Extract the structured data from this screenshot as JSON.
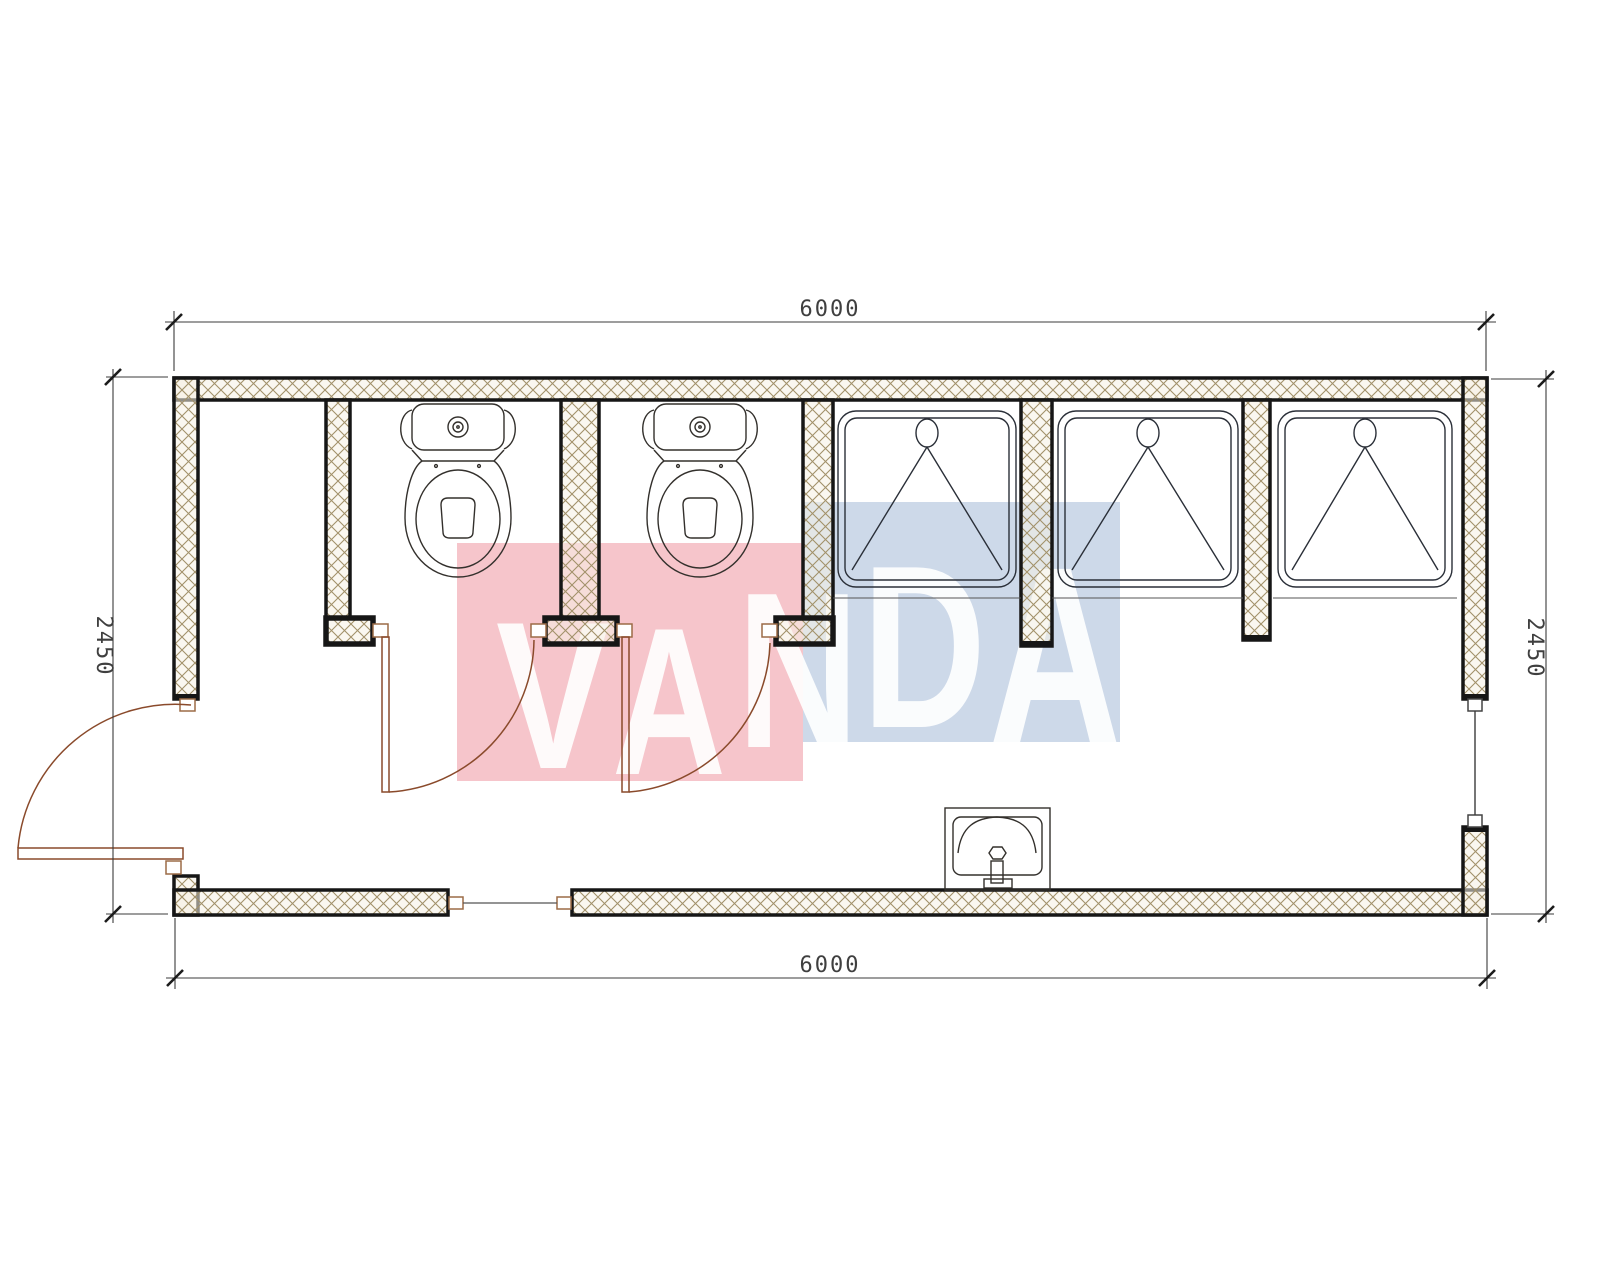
{
  "title": "Sanitary container floor plan 6000 x 2450",
  "watermark": {
    "text": "VANDA",
    "letters": [
      "V",
      "A",
      "N",
      "D",
      "A"
    ],
    "pink_color": "#f6c5cb",
    "blue_color": "#cdd9e9",
    "text_color": "rgba(255,255,255,0.9)"
  },
  "dimensions": {
    "top": "6000",
    "bottom": "6000",
    "left": "2450",
    "right": "2450",
    "units": "mm"
  },
  "plan": {
    "type": "floor-plan",
    "building": "sanitary container with toilets and showers",
    "outer_width_mm": 6000,
    "outer_depth_mm": 2450,
    "rooms": [
      {
        "name": "entry-vestibule",
        "position": "far-left"
      },
      {
        "name": "wc-cubicle-1",
        "fixture": "toilet"
      },
      {
        "name": "wc-cubicle-2",
        "fixture": "toilet"
      },
      {
        "name": "shower-stall-1",
        "fixture": "shower-tray"
      },
      {
        "name": "shower-stall-2",
        "fixture": "shower-tray"
      },
      {
        "name": "shower-stall-3",
        "fixture": "shower-tray"
      },
      {
        "name": "corridor",
        "fixture": "washbasin"
      }
    ],
    "fixtures": {
      "toilets": 2,
      "showers": 3,
      "washbasins": 1
    },
    "openings": {
      "exterior_door_left_wall": 1,
      "interior_cubicle_doors": 2,
      "front_wall_opening": 1,
      "window_right_wall": 1
    },
    "colors": {
      "wall_line": "#161616",
      "hatch_line": "#a2916a",
      "hatch_fill": "rgba(246,241,228,0.55)",
      "fixture_line": "#2e333b",
      "door_line": "#8a4a2b",
      "dimension_line": "#3b3b3b"
    }
  }
}
